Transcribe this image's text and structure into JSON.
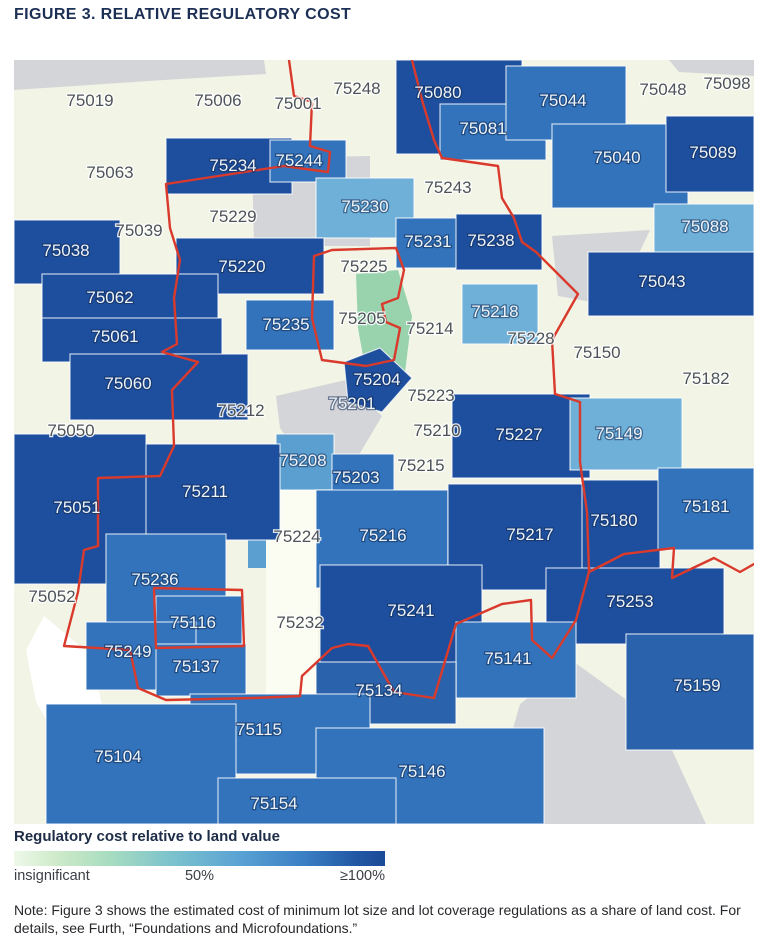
{
  "title": "FIGURE 3. RELATIVE REGULATORY COST",
  "legend": {
    "title": "Regulatory cost relative to land value",
    "label_low": "insignificant",
    "label_mid": "50%",
    "label_high": "≥100%"
  },
  "note": "Note: Figure 3 shows the estimated cost of minimum lot size and lot coverage regulations as a share of land cost. For details, see Furth, “Foundations and Microfoundations.”",
  "map": {
    "palette": {
      "dark": "#1e4f9e",
      "med": "#3273bb",
      "medDark": "#2a63ac",
      "light": "#6fb0d8",
      "lightMed": "#5a9fd0",
      "paleGreen": "#98d3ae",
      "cream": "#f2f4e6",
      "strip": "#fbfcf2",
      "gray": "#d4d5d8",
      "white": "#ffffff"
    },
    "boundary": {
      "color": "#d93a2c",
      "width": 2.4,
      "lines": [
        "275,0 280,36 298,42 296,86 316,92 314,112 270,106 152,124 156,168 166,200 160,238 163,284 148,292 184,302 158,330 160,386 146,416 84,418 84,486 70,490 64,532 50,586 116,590 124,628 152,640 240,638 286,636 288,616 318,588 334,584 354,586 380,632 420,638",
        "398,0 408,40 420,80 428,98 484,106 488,138 500,158 508,182 522,192 564,234 538,280 541,334 566,342 566,402 573,452 575,512 562,560 538,598 518,580 517,540 488,544 442,564 420,638",
        "575,512 610,494 660,488 658,518 700,498 726,512 740,504"
      ],
      "loops": [
        "300,196 318,190 382,188 390,210 384,238 368,244 372,262 386,268 380,300 352,306 308,300 298,258",
        "140,528 228,530 230,586 142,588"
      ]
    },
    "patches": [
      {
        "name": "no-data-top-strip",
        "fill": "gray",
        "pts": "0,0 250,0 252,14 150,20 60,26 0,30"
      },
      {
        "name": "no-data-top-right",
        "fill": "gray",
        "pts": "655,0 740,0 740,16 665,12"
      },
      {
        "name": "no-data-75240-area",
        "fill": "gray",
        "pts": "238,98 356,96 356,186 240,186"
      },
      {
        "name": "no-data-downtown",
        "fill": "gray",
        "pts": "262,336 332,320 368,356 342,400 286,398 266,368"
      },
      {
        "name": "no-data-northeast",
        "fill": "gray",
        "pts": "538,176 636,170 600,246 544,236"
      },
      {
        "name": "no-data-floodplain",
        "fill": "gray",
        "pts": "506,644 560,602 646,664 692,764 472,764"
      },
      {
        "name": "lake",
        "fill": "white",
        "pts": "30,556 78,596 94,676 58,702 22,642 12,590"
      },
      {
        "name": "insignificant-corridor",
        "fill": "paleGreen",
        "pts": "342,214 384,210 398,256 390,320 354,324 344,268"
      },
      {
        "name": "light-corridor",
        "fill": "lightMed",
        "pts": "234,402 256,402 256,508 234,508"
      },
      {
        "name": "white-corridor-75224-75232",
        "fill": "strip",
        "pts": "252,404 304,404 304,636 252,636"
      }
    ],
    "regions": [
      {
        "code": "75080",
        "fill": "dark",
        "rect": [
          382,
          0,
          126,
          94
        ],
        "label": [
          424,
          38
        ],
        "labelStyle": "light"
      },
      {
        "code": "75081",
        "fill": "med",
        "rect": [
          426,
          44,
          106,
          56
        ],
        "label": [
          469,
          74
        ],
        "labelStyle": "light"
      },
      {
        "code": "75044",
        "fill": "med",
        "rect": [
          492,
          6,
          120,
          74
        ],
        "label": [
          549,
          46
        ],
        "labelStyle": "light"
      },
      {
        "code": "75040",
        "fill": "med",
        "rect": [
          538,
          64,
          136,
          84
        ],
        "label": [
          603,
          103
        ],
        "labelStyle": "light"
      },
      {
        "code": "75089",
        "fill": "dark",
        "rect": [
          652,
          56,
          88,
          76
        ],
        "label": [
          699,
          98
        ],
        "labelStyle": "light"
      },
      {
        "code": "75088",
        "fill": "light",
        "rect": [
          640,
          144,
          100,
          50
        ],
        "label": [
          691,
          172
        ],
        "labelStyle": "light"
      },
      {
        "code": "75043",
        "fill": "dark",
        "rect": [
          574,
          192,
          166,
          64
        ],
        "label": [
          648,
          227
        ],
        "labelStyle": "light"
      },
      {
        "code": "75234",
        "fill": "dark",
        "rect": [
          152,
          78,
          126,
          56
        ],
        "label": [
          219,
          111
        ],
        "labelStyle": "light"
      },
      {
        "code": "75244",
        "fill": "med",
        "rect": [
          256,
          80,
          76,
          42
        ],
        "label": [
          285,
          106
        ],
        "labelStyle": "light"
      },
      {
        "code": "75230",
        "fill": "light",
        "rect": [
          302,
          118,
          98,
          60
        ],
        "label": [
          351,
          152
        ],
        "labelStyle": "light"
      },
      {
        "code": "75231",
        "fill": "med",
        "rect": [
          382,
          158,
          74,
          50
        ],
        "label": [
          414,
          187
        ],
        "labelStyle": "light"
      },
      {
        "code": "75238",
        "fill": "dark",
        "rect": [
          442,
          154,
          86,
          56
        ],
        "label": [
          477,
          186
        ],
        "labelStyle": "light"
      },
      {
        "code": "75220",
        "fill": "dark",
        "rect": [
          162,
          178,
          148,
          56
        ],
        "label": [
          228,
          212
        ],
        "labelStyle": "light"
      },
      {
        "code": "75038",
        "fill": "dark",
        "rect": [
          0,
          160,
          106,
          64
        ],
        "label": [
          52,
          196
        ],
        "labelStyle": "light"
      },
      {
        "code": "75062",
        "fill": "dark",
        "rect": [
          28,
          214,
          176,
          50
        ],
        "label": [
          96,
          243
        ],
        "labelStyle": "light"
      },
      {
        "code": "75061",
        "fill": "dark",
        "rect": [
          28,
          258,
          180,
          44
        ],
        "label": [
          101,
          282
        ],
        "labelStyle": "light"
      },
      {
        "code": "75060",
        "fill": "dark",
        "rect": [
          56,
          294,
          178,
          66
        ],
        "label": [
          114,
          329
        ],
        "labelStyle": "light"
      },
      {
        "code": "75235",
        "fill": "med",
        "rect": [
          232,
          240,
          88,
          50
        ],
        "label": [
          272,
          270
        ],
        "labelStyle": "light"
      },
      {
        "code": "75218",
        "fill": "light",
        "rect": [
          448,
          224,
          76,
          60
        ],
        "label": [
          481,
          257
        ],
        "labelStyle": "light"
      },
      {
        "code": "75204",
        "fill": "dark",
        "pts": "330,302 366,288 398,318 368,352 334,342",
        "label": [
          363,
          325
        ],
        "labelStyle": "light"
      },
      {
        "code": "75227",
        "fill": "dark",
        "rect": [
          438,
          334,
          138,
          84
        ],
        "label": [
          505,
          380
        ],
        "labelStyle": "light"
      },
      {
        "code": "75149",
        "fill": "light",
        "rect": [
          556,
          338,
          112,
          72
        ],
        "label": [
          605,
          379
        ],
        "labelStyle": "light"
      },
      {
        "code": "75208",
        "fill": "lightMed",
        "rect": [
          262,
          374,
          58,
          56
        ],
        "label": [
          289,
          406
        ],
        "labelStyle": "light"
      },
      {
        "code": "75203",
        "fill": "med",
        "rect": [
          318,
          394,
          62,
          46
        ],
        "label": [
          342,
          423
        ],
        "labelStyle": "light"
      },
      {
        "code": "75211",
        "fill": "dark",
        "rect": [
          118,
          384,
          148,
          96
        ],
        "label": [
          191,
          437
        ],
        "labelStyle": "light"
      },
      {
        "code": "75051",
        "fill": "dark",
        "rect": [
          0,
          374,
          132,
          150
        ],
        "label": [
          63,
          453
        ],
        "labelStyle": "light"
      },
      {
        "code": "75216",
        "fill": "med",
        "rect": [
          302,
          430,
          132,
          98
        ],
        "label": [
          369,
          481
        ],
        "labelStyle": "light"
      },
      {
        "code": "75217",
        "fill": "dark",
        "rect": [
          434,
          424,
          176,
          106
        ],
        "label": [
          516,
          480
        ],
        "labelStyle": "light"
      },
      {
        "code": "75180",
        "fill": "dark",
        "rect": [
          568,
          420,
          78,
          90
        ],
        "label": [
          600,
          466
        ],
        "labelStyle": "light"
      },
      {
        "code": "75181",
        "fill": "med",
        "rect": [
          644,
          408,
          96,
          82
        ],
        "label": [
          692,
          452
        ],
        "labelStyle": "light"
      },
      {
        "code": "75236",
        "fill": "med",
        "rect": [
          92,
          474,
          120,
          90
        ],
        "label": [
          141,
          525
        ],
        "labelStyle": "light"
      },
      {
        "code": "75241",
        "fill": "dark",
        "rect": [
          306,
          505,
          162,
          120
        ],
        "label": [
          397,
          556
        ],
        "labelStyle": "light"
      },
      {
        "code": "75253",
        "fill": "dark",
        "rect": [
          532,
          508,
          178,
          76
        ],
        "label": [
          616,
          547
        ],
        "labelStyle": "light"
      },
      {
        "code": "75116",
        "fill": "med",
        "rect": [
          142,
          536,
          86,
          50
        ],
        "label": [
          179,
          568
        ],
        "labelStyle": "light"
      },
      {
        "code": "75249",
        "fill": "med",
        "rect": [
          72,
          562,
          110,
          68
        ],
        "label": [
          114,
          597
        ],
        "labelStyle": "light"
      },
      {
        "code": "75137",
        "fill": "med",
        "rect": [
          142,
          584,
          90,
          52
        ],
        "label": [
          182,
          612
        ],
        "labelStyle": "light"
      },
      {
        "code": "75141",
        "fill": "med",
        "rect": [
          442,
          562,
          120,
          76
        ],
        "label": [
          494,
          604
        ],
        "labelStyle": "light"
      },
      {
        "code": "75134",
        "fill": "medDark",
        "rect": [
          302,
          602,
          140,
          62
        ],
        "label": [
          365,
          636
        ],
        "labelStyle": "light"
      },
      {
        "code": "75159",
        "fill": "medDark",
        "rect": [
          612,
          574,
          128,
          116
        ],
        "label": [
          683,
          631
        ],
        "labelStyle": "light"
      },
      {
        "code": "75115",
        "fill": "med",
        "rect": [
          176,
          634,
          180,
          80
        ],
        "label": [
          245,
          675
        ],
        "labelStyle": "light"
      },
      {
        "code": "75104",
        "fill": "med",
        "rect": [
          32,
          644,
          190,
          120
        ],
        "label": [
          104,
          702
        ],
        "labelStyle": "light"
      },
      {
        "code": "75146",
        "fill": "med",
        "rect": [
          302,
          668,
          228,
          96
        ],
        "label": [
          408,
          717
        ],
        "labelStyle": "light"
      },
      {
        "code": "75154",
        "fill": "med",
        "rect": [
          204,
          718,
          178,
          46
        ],
        "label": [
          260,
          749
        ],
        "labelStyle": "light"
      },
      {
        "code": "75019",
        "label": [
          76,
          46
        ],
        "labelStyle": "dark"
      },
      {
        "code": "75006",
        "label": [
          204,
          46
        ],
        "labelStyle": "dark"
      },
      {
        "code": "75001",
        "label": [
          284,
          49
        ],
        "labelStyle": "dark"
      },
      {
        "code": "75248",
        "label": [
          343,
          34
        ],
        "labelStyle": "dark"
      },
      {
        "code": "75048",
        "label": [
          649,
          35
        ],
        "labelStyle": "dark"
      },
      {
        "code": "75098",
        "label": [
          713,
          29
        ],
        "labelStyle": "dark"
      },
      {
        "code": "75063",
        "label": [
          96,
          118
        ],
        "labelStyle": "dark"
      },
      {
        "code": "75243",
        "label": [
          434,
          133
        ],
        "labelStyle": "dark"
      },
      {
        "code": "75229",
        "label": [
          219,
          162
        ],
        "labelStyle": "dark"
      },
      {
        "code": "75039",
        "label": [
          125,
          176
        ],
        "labelStyle": "dark"
      },
      {
        "code": "75225",
        "label": [
          350,
          212
        ],
        "labelStyle": "dark"
      },
      {
        "code": "75205",
        "label": [
          348,
          264
        ],
        "labelStyle": "dark"
      },
      {
        "code": "75214",
        "label": [
          416,
          274
        ],
        "labelStyle": "dark"
      },
      {
        "code": "75228",
        "label": [
          517,
          284
        ],
        "labelStyle": "dark"
      },
      {
        "code": "75150",
        "label": [
          583,
          298
        ],
        "labelStyle": "dark"
      },
      {
        "code": "75182",
        "label": [
          692,
          324
        ],
        "labelStyle": "dark"
      },
      {
        "code": "75223",
        "label": [
          417,
          341
        ],
        "labelStyle": "dark"
      },
      {
        "code": "75201",
        "label": [
          338,
          349
        ],
        "labelStyle": "light"
      },
      {
        "code": "75212",
        "label": [
          227,
          356
        ],
        "labelStyle": "dark"
      },
      {
        "code": "75210",
        "label": [
          423,
          376
        ],
        "labelStyle": "dark"
      },
      {
        "code": "75050",
        "label": [
          57,
          376
        ],
        "labelStyle": "dark"
      },
      {
        "code": "75215",
        "label": [
          407,
          411
        ],
        "labelStyle": "dark"
      },
      {
        "code": "75052",
        "label": [
          38,
          542
        ],
        "labelStyle": "dark"
      },
      {
        "code": "75224",
        "label": [
          283,
          482
        ],
        "labelStyle": "dark"
      },
      {
        "code": "75232",
        "label": [
          286,
          568
        ],
        "labelStyle": "dark"
      }
    ]
  }
}
